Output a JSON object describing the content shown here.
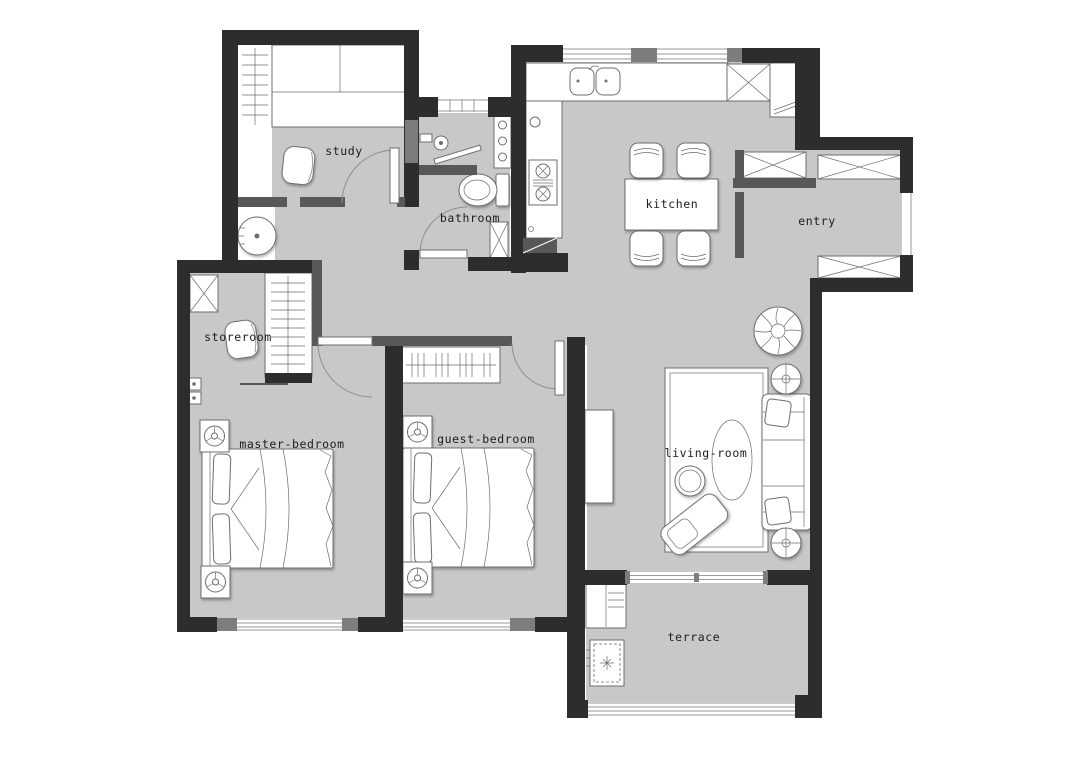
{
  "title": "apartment-floor-plan",
  "colors": {
    "bg": "#ffffff",
    "wall": "#2d2d2d",
    "partition": "#585858",
    "jamb": "#7d7d7d",
    "floor": "#c8c8c8",
    "line": "#6e6e6e",
    "text": "#1c1c1c"
  },
  "rooms": {
    "study": {
      "label": "study"
    },
    "bathroom": {
      "label": "bathroom"
    },
    "kitchen": {
      "label": "kitchen"
    },
    "entry": {
      "label": "entry"
    },
    "storeroom": {
      "label": "storeroom"
    },
    "master_bedroom": {
      "label": "master-bedroom"
    },
    "guest_bedroom": {
      "label": "guest-bedroom"
    },
    "living_room": {
      "label": "living-room"
    },
    "terrace": {
      "label": "terrace"
    }
  },
  "furniture_icons": [
    "double-bed-icon",
    "nightstand-lamp-icon",
    "wardrobe-hangers-icon",
    "shoe-cabinet-x-icon",
    "dining-table-icon",
    "dining-chair-icon",
    "sofa-icon",
    "coffee-table-icon",
    "side-table-icon",
    "plant-icon",
    "rug-icon",
    "tv-console-icon",
    "chaise-icon",
    "toilet-icon",
    "shower-icon",
    "washbasin-cabinet-icon",
    "kitchen-sink-icon",
    "stove-icon",
    "fridge-cabinet-icon",
    "washing-machine-icon",
    "desk-icon",
    "round-table-icon",
    "desk-chair-icon",
    "door-swing-icon",
    "window-icon",
    "sliding-door-icon",
    "light-switch-icon"
  ]
}
